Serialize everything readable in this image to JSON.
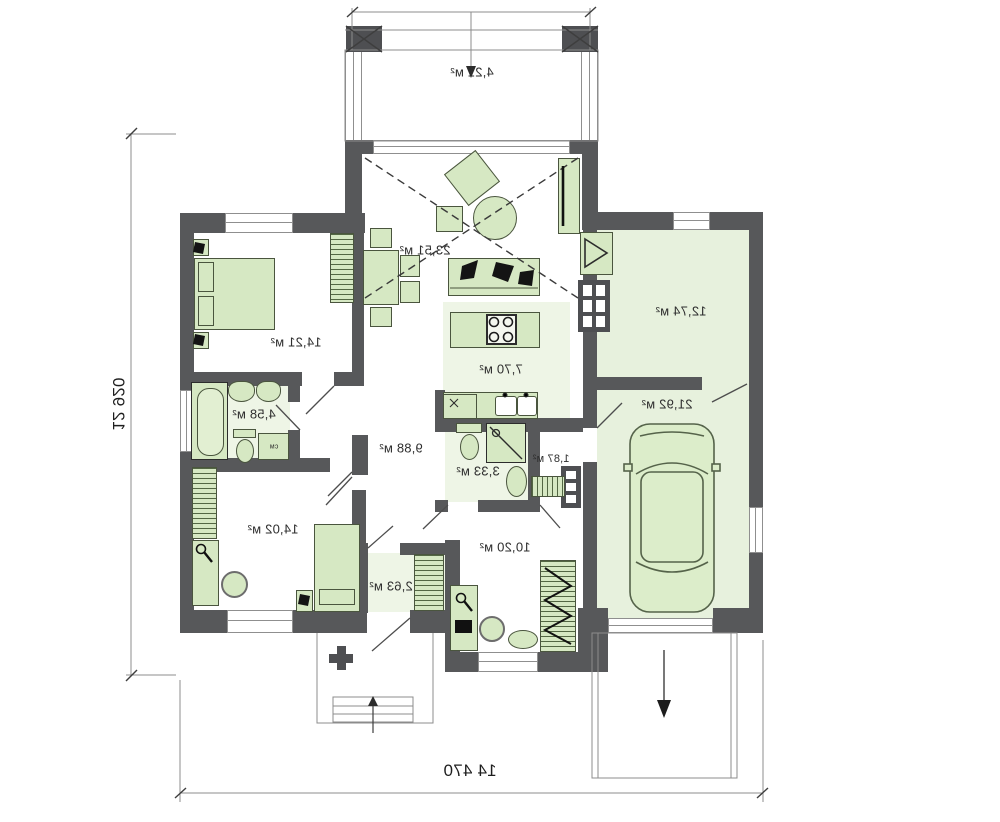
{
  "plan": {
    "type": "single-storey house floor plan (mirrored print)",
    "overall_dimensions": {
      "width": "14 470",
      "height": "12 920"
    },
    "rooms": {
      "terrace": "4,21 м²",
      "living": "23,51 м²",
      "bedroom_top": "14,21 м²",
      "kitchen": "7,70 м²",
      "bathroom": "4,58 м²",
      "hall": "9,88 м²",
      "shower_wc": "3,33 м²",
      "vestibule": "1,87 м²",
      "corridor": "10,20 м²",
      "closet": "2,63 м²",
      "bedroom_bottom": "14,02 м²",
      "utility": "12,74 м²",
      "garage": "21,92 м²"
    },
    "appliances": {
      "washing_machine": "см"
    },
    "colors": {
      "wall": "#57585a",
      "furniture_fill": "#d6e8c3",
      "furniture_border": "#4a553e",
      "tinted_floor": "#e7f1dd",
      "line": "#555555"
    }
  }
}
